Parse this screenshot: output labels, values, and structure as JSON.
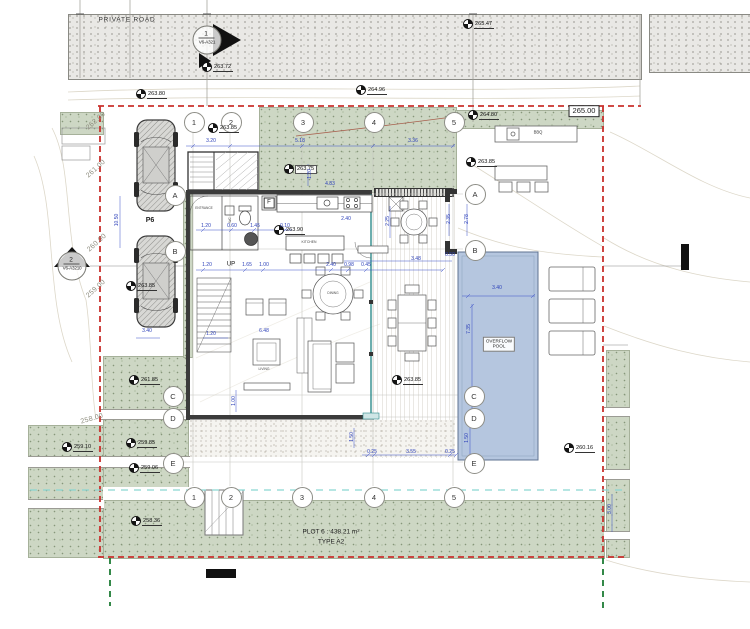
{
  "road": {
    "label": "PRIVATE ROAD"
  },
  "plot": {
    "title": "PLOT 6 : 438.21 m²",
    "type": "TYPE A2",
    "parking": "P6"
  },
  "pool": {
    "label": "OVERFLOW\nPOOL"
  },
  "boundary_level_box": "265.00",
  "section_markers": {
    "top": {
      "num": "1",
      "sheet": "V6-A321"
    },
    "left": {
      "num": "2",
      "sheet": "V6-A3210"
    }
  },
  "colors": {
    "boundary_red": "#c9302c",
    "setback_green": "#1d7c35",
    "utility_cyan": "#8ad6d2",
    "dimension_blue": "#2a3eb8",
    "pool_fill": "#b5c6df",
    "landscape_green": "#cdd7c4",
    "road_gray": "#e9e8e5",
    "glass_teal": "#2e8b8b"
  },
  "grid_bubbles": [
    {
      "v": "1",
      "x": 193,
      "y": 121
    },
    {
      "v": "2",
      "x": 230,
      "y": 121
    },
    {
      "v": "3",
      "x": 302,
      "y": 121
    },
    {
      "v": "4",
      "x": 373,
      "y": 121
    },
    {
      "v": "5",
      "x": 453,
      "y": 121
    },
    {
      "v": "1",
      "x": 193,
      "y": 496
    },
    {
      "v": "2",
      "x": 230,
      "y": 496
    },
    {
      "v": "3",
      "x": 301,
      "y": 496
    },
    {
      "v": "4",
      "x": 373,
      "y": 496
    },
    {
      "v": "5",
      "x": 453,
      "y": 496
    },
    {
      "v": "A",
      "x": 174,
      "y": 194
    },
    {
      "v": "B",
      "x": 174,
      "y": 250
    },
    {
      "v": "C",
      "x": 172,
      "y": 395
    },
    {
      "v": "D",
      "x": 172,
      "y": 417
    },
    {
      "v": "E",
      "x": 172,
      "y": 462
    },
    {
      "v": "A",
      "x": 474,
      "y": 193
    },
    {
      "v": "B",
      "x": 474,
      "y": 249
    },
    {
      "v": "C",
      "x": 473,
      "y": 395
    },
    {
      "v": "D",
      "x": 473,
      "y": 417
    },
    {
      "v": "E",
      "x": 473,
      "y": 462
    }
  ],
  "spot_levels": [
    {
      "v": "263.72",
      "x": 202,
      "y": 63
    },
    {
      "v": "263.80",
      "x": 136,
      "y": 90
    },
    {
      "v": "264.96",
      "x": 356,
      "y": 86
    },
    {
      "v": "265.47",
      "x": 463,
      "y": 20
    },
    {
      "v": "264.80",
      "x": 468,
      "y": 111
    },
    {
      "v": "263.85",
      "x": 208,
      "y": 124
    },
    {
      "v": "263.75",
      "x": 284,
      "y": 165,
      "boxed": true
    },
    {
      "v": "263.90",
      "x": 274,
      "y": 226
    },
    {
      "v": "263.85",
      "x": 466,
      "y": 158
    },
    {
      "v": "263.85",
      "x": 126,
      "y": 282
    },
    {
      "v": "263.85",
      "x": 392,
      "y": 376
    },
    {
      "v": "261.85",
      "x": 129,
      "y": 376
    },
    {
      "v": "259.85",
      "x": 126,
      "y": 439
    },
    {
      "v": "259.06",
      "x": 129,
      "y": 464
    },
    {
      "v": "259.10",
      "x": 62,
      "y": 443
    },
    {
      "v": "260.16",
      "x": 564,
      "y": 444
    },
    {
      "v": "258.36",
      "x": 131,
      "y": 517
    }
  ],
  "contour_labels": [
    {
      "v": "262.00",
      "x": 96,
      "y": 121,
      "r": -42
    },
    {
      "v": "261.00",
      "x": 96,
      "y": 169,
      "r": -42
    },
    {
      "v": "260.00",
      "x": 97,
      "y": 243,
      "r": -42
    },
    {
      "v": "259.00",
      "x": 96,
      "y": 289,
      "r": -42
    },
    {
      "v": "258.00",
      "x": 92,
      "y": 419,
      "r": -16
    }
  ],
  "dimensions": [
    {
      "v": "3.20",
      "x": 211,
      "y": 141
    },
    {
      "v": "5.18",
      "x": 300,
      "y": 141
    },
    {
      "v": "3.36",
      "x": 413,
      "y": 141
    },
    {
      "v": "4.83",
      "x": 330,
      "y": 184
    },
    {
      "v": "1.20",
      "x": 310,
      "y": 174,
      "r": -90
    },
    {
      "v": "2.40",
      "x": 346,
      "y": 219
    },
    {
      "v": "1.20",
      "x": 206,
      "y": 226
    },
    {
      "v": "0.60",
      "x": 232,
      "y": 226
    },
    {
      "v": "1.45",
      "x": 255,
      "y": 226
    },
    {
      "v": "0.10",
      "x": 285,
      "y": 226
    },
    {
      "v": "2.35",
      "x": 449,
      "y": 219,
      "r": -90
    },
    {
      "v": "2.78",
      "x": 467,
      "y": 219,
      "r": -90
    },
    {
      "v": "2.25",
      "x": 388,
      "y": 221,
      "r": -90
    },
    {
      "v": "1.20",
      "x": 207,
      "y": 265
    },
    {
      "v": "1.65",
      "x": 247,
      "y": 265
    },
    {
      "v": "1.00",
      "x": 264,
      "y": 265
    },
    {
      "v": "2.40",
      "x": 331,
      "y": 265
    },
    {
      "v": "0.98",
      "x": 349,
      "y": 265
    },
    {
      "v": "0.45",
      "x": 366,
      "y": 265
    },
    {
      "v": "3.48",
      "x": 416,
      "y": 259
    },
    {
      "v": "0.50",
      "x": 450,
      "y": 255
    },
    {
      "v": "3.40",
      "x": 497,
      "y": 288
    },
    {
      "v": "7.35",
      "x": 469,
      "y": 329,
      "r": -90
    },
    {
      "v": "1.50",
      "x": 467,
      "y": 438,
      "r": -90
    },
    {
      "v": "6.48",
      "x": 264,
      "y": 331
    },
    {
      "v": "1.20",
      "x": 211,
      "y": 334
    },
    {
      "v": "1.00",
      "x": 234,
      "y": 401,
      "r": -90
    },
    {
      "v": "3.40",
      "x": 147,
      "y": 331
    },
    {
      "v": "10.50",
      "x": 117,
      "y": 220,
      "r": -90
    },
    {
      "v": "1.50",
      "x": 352,
      "y": 437,
      "r": -90
    },
    {
      "v": "0.25",
      "x": 372,
      "y": 452
    },
    {
      "v": "3.55",
      "x": 411,
      "y": 452
    },
    {
      "v": "0.25",
      "x": 450,
      "y": 452
    },
    {
      "v": "3.00",
      "x": 610,
      "y": 509,
      "r": -90
    }
  ],
  "text_labels": [
    {
      "v": "PRIVATE ROAD",
      "x": 127,
      "y": 20,
      "s": 6.5,
      "ls": 0.8,
      "c": "#333",
      "n": "road-label"
    },
    {
      "v": "P6",
      "x": 150,
      "y": 221,
      "s": 7,
      "w": 700,
      "n": "parking-label"
    },
    {
      "v": "UP",
      "x": 231,
      "y": 265,
      "s": 6,
      "c": "#111",
      "n": "stair-up-label"
    },
    {
      "v": "F",
      "x": 269,
      "y": 203,
      "s": 6,
      "cls": "ftag",
      "n": "fridge-tag"
    },
    {
      "v": "ENTRANCE",
      "x": 204,
      "y": 209,
      "s": 3.2,
      "c": "#444",
      "n": "entrance-label"
    },
    {
      "v": "WC",
      "x": 231,
      "y": 220,
      "s": 3.2,
      "r": -90,
      "c": "#444",
      "n": "wc-label"
    },
    {
      "v": "KITCHEN",
      "x": 309,
      "y": 243,
      "s": 3.4,
      "c": "#444",
      "n": "kitchen-label"
    },
    {
      "v": "DINING",
      "x": 333,
      "y": 294,
      "s": 3.2,
      "c": "#444",
      "n": "dining-label"
    },
    {
      "v": "LIVING",
      "x": 264,
      "y": 370,
      "s": 3.4,
      "c": "#444",
      "n": "living-label"
    },
    {
      "v": "BBQ",
      "x": 538,
      "y": 133,
      "s": 4.2,
      "c": "#333",
      "n": "bbq-label"
    },
    {
      "v": "OVERFLOW\nPOOL",
      "x": 499,
      "y": 344,
      "s": 4.6,
      "cls": "bxl",
      "n": "pool-label"
    },
    {
      "v": "PLOT 6 : 438.21 m²",
      "x": 331,
      "y": 532,
      "s": 6.5,
      "n": "plot-title"
    },
    {
      "v": "TYPE A2",
      "x": 331,
      "y": 542,
      "s": 6.5,
      "n": "plot-type"
    },
    {
      "v": "265.00",
      "x": 584,
      "y": 111,
      "s": 7.5,
      "cls": "lvl-box",
      "n": "boundary-level-box"
    }
  ]
}
